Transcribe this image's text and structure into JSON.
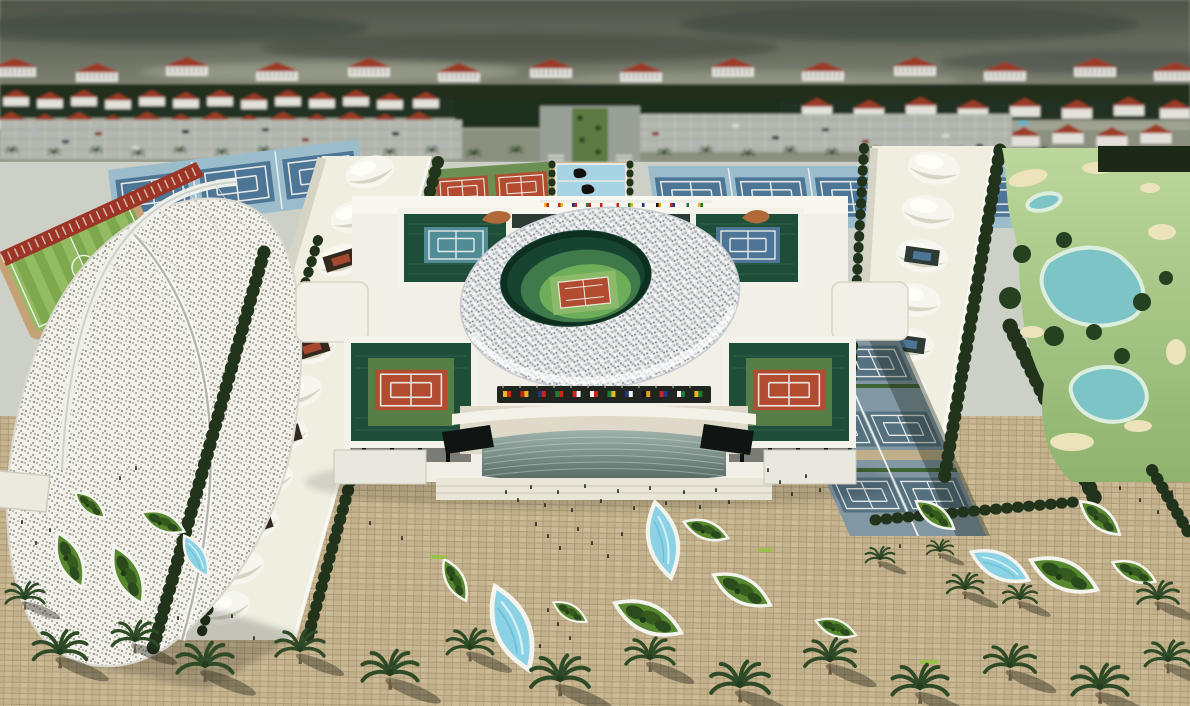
{
  "meta": {
    "title": "Aerial rendering of a tennis-stadium sports complex",
    "type": "architectural-rendering",
    "time_of_day": "overcast daylight"
  },
  "palette": {
    "sky_top": "#4e5348",
    "sky_bottom": "#a3a694",
    "cloud": "#3c423a",
    "bg_wall": "#e3e2da",
    "bg_roof": "#9c3a25",
    "bg_tree": "#1d2918",
    "parking": "#b2b7af",
    "road": "#99a098",
    "median": "#5d7a42",
    "concrete": "#ccd0c7",
    "canopy": "#efeee1",
    "canopy_shade": "#d6d4c4",
    "sail": "#f2f1e9",
    "fence_red": "#9c3526",
    "track_tan": "#c4a276",
    "pitch_a": "#7ea84e",
    "pitch_b": "#93bc62",
    "clay": "#b24c31",
    "clay_surround": "#6c9053",
    "blue_court": "#4c7596",
    "blue_surround": "#9abccb",
    "hard_court": "#55707f",
    "hard_surround": "#8297a4",
    "stand_green": "#1e4e3a",
    "teal_court": "#4f8c96",
    "bowl_dark": "#174430",
    "bowl_light": "#6fae58",
    "stadium_white": "#f1efe6",
    "facade": "#ded9c8",
    "plaza": "#c6b590",
    "plaza_line": "#a8946e",
    "leaf_green": "#57882f",
    "leaf_rim": "#f4f4ee",
    "water": "#8ad2e4",
    "golf_light": "#bcd79c",
    "golf_dark": "#8fb36e",
    "sand": "#ece3bb",
    "pond": "#7cc4c6",
    "tree_dark": "#22331c",
    "palm_green": "#2e4a26",
    "trunk": "#6b5a42",
    "person": "#23231e",
    "flag_band": "#20261f",
    "sculpture": "#b06a3a",
    "fountain_pool": "#a6d4e4"
  },
  "flags": {
    "colors": [
      [
        "#e8b820",
        "#c8281e"
      ],
      [
        "#cc2418",
        "#e8b820"
      ],
      [
        "#23367c",
        "#cc2418"
      ],
      [
        "#1e7a34",
        "#cc2418"
      ],
      [
        "#cc2418",
        "#f2f2f2"
      ],
      [
        "#f2f2f2",
        "#cc2418"
      ],
      [
        "#1e7a34",
        "#e8b820"
      ],
      [
        "#23367c",
        "#f2f2f2"
      ],
      [
        "#111111",
        "#e0a010"
      ],
      [
        "#cc2418",
        "#1e3c8c"
      ],
      [
        "#f2f2f2",
        "#1e7a34"
      ],
      [
        "#e8b820",
        "#1e7a34"
      ]
    ]
  },
  "scene": {
    "background": {
      "housing": "rows of white apartment blocks and townhouses with terracotta roofs",
      "parking": "two large parking lots with scattered cars",
      "boulevard": "palm-lined entry boulevard with planted median"
    },
    "left_zone": {
      "field": "grass pitch with running track behind red lattice fence",
      "sail": "white perforated sail canopy with arched mast over grandstand"
    },
    "courts": {
      "clay_block": "six clay courts with green surrounds",
      "blue_blocks": "blue hard-court blocks north of the stadium",
      "covered_rows": "court rows under white tensile pillow canopies",
      "open_hard_courts": "slate-blue practice courts east of the stadium"
    },
    "stadium": {
      "ring_roof": "white lattice ring roof over sunken green bowl",
      "centre_court": "clay centre court inside the bowl",
      "corner_courts": "four sunken corner courts (teal, blue, clay, clay)",
      "entrance": "curved glass entrance facade with row of international flags",
      "roof_sculptures": "two tan feline sculptures on the north parapet",
      "fountain_plaza": "three blue fountain pools with dark statues north of the stadium"
    },
    "golf_course": "golf fairways with sand bunkers, ponds and tree clusters",
    "plaza": "sand-paved esplanade with leaf-shaped planters, leaf-shaped reflecting pools, palm trees and visitors"
  }
}
